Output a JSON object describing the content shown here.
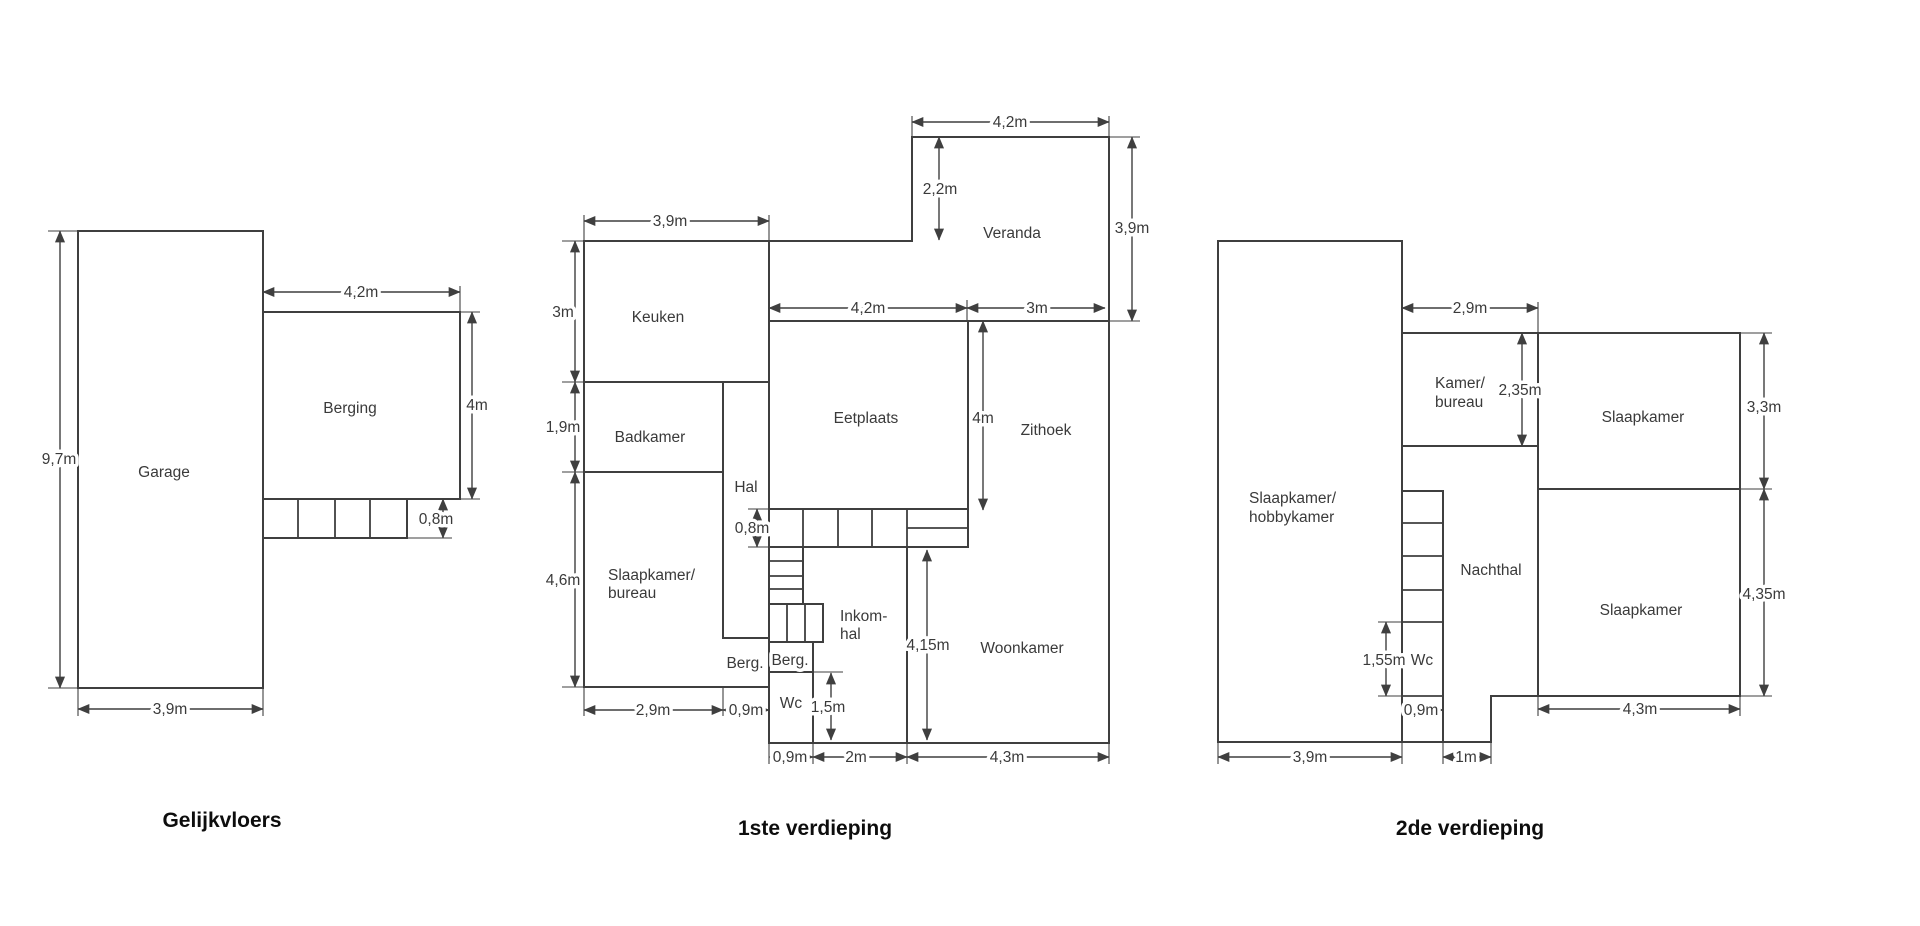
{
  "page": {
    "background": "#ffffff",
    "wall_color": "#3f3f3f",
    "text_color": "#3a3a3a",
    "title_color": "#0d0d0d"
  },
  "floors": [
    {
      "title": "Gelijkvloers",
      "rooms": {
        "garage": "Garage",
        "berging": "Berging"
      },
      "dims": {
        "garage_height": "9,7m",
        "berging_width": "4,2m",
        "berging_height": "4m",
        "steps_depth": "0,8m",
        "garage_width": "3,9m"
      }
    },
    {
      "title": "1ste verdieping",
      "rooms": {
        "keuken": "Keuken",
        "badkamer": "Badkamer",
        "hal": "Hal",
        "slaapkamer_line1": "Slaapkamer/",
        "slaapkamer_line2": "bureau",
        "eetplaats": "Eetplaats",
        "zithoek": "Zithoek",
        "veranda": "Veranda",
        "woonkamer": "Woonkamer",
        "inkomhal_line1": "Inkom-",
        "inkomhal_line2": "hal",
        "berg_left": "Berg.",
        "berg_right": "Berg.",
        "wc": "Wc"
      },
      "dims": {
        "keuken_width": "3,9m",
        "keuken_height": "3m",
        "badkamer_height": "1,9m",
        "slaapkamer_height": "4,6m",
        "veranda_width": "4,2m",
        "veranda_inset": "2,2m",
        "veranda_height": "3,9m",
        "eetplaats_width": "4,2m",
        "zithoek_width": "3m",
        "steps_depth": "0,8m",
        "eetplaats_height": "4m",
        "woonkamer_height": "4,15m",
        "wc_height": "1,5m",
        "slaapkamer_width": "2,9m",
        "hal_width": "0,9m",
        "wc_width": "0,9m",
        "inkomhal_width": "2m",
        "woonkamer_width": "4,3m"
      }
    },
    {
      "title": "2de verdieping",
      "rooms": {
        "slaapkamer_hobby_line1": "Slaapkamer/",
        "slaapkamer_hobby_line2": "hobbykamer",
        "kamer_line1": "Kamer/",
        "kamer_line2": "bureau",
        "slaapkamer_top": "Slaapkamer",
        "nachthal": "Nachthal",
        "wc": "Wc",
        "slaapkamer_bottom": "Slaapkamer"
      },
      "dims": {
        "kamer_width": "2,9m",
        "kamer_height": "2,35m",
        "slaapkamer_top_height": "3,3m",
        "slaapkamer_bottom_height": "4,35m",
        "wc_height": "1,55m",
        "wc_width": "0,9m",
        "plan_width": "3,9m",
        "passage_width": "1m",
        "slaapkamer_bottom_width": "4,3m"
      }
    }
  ]
}
